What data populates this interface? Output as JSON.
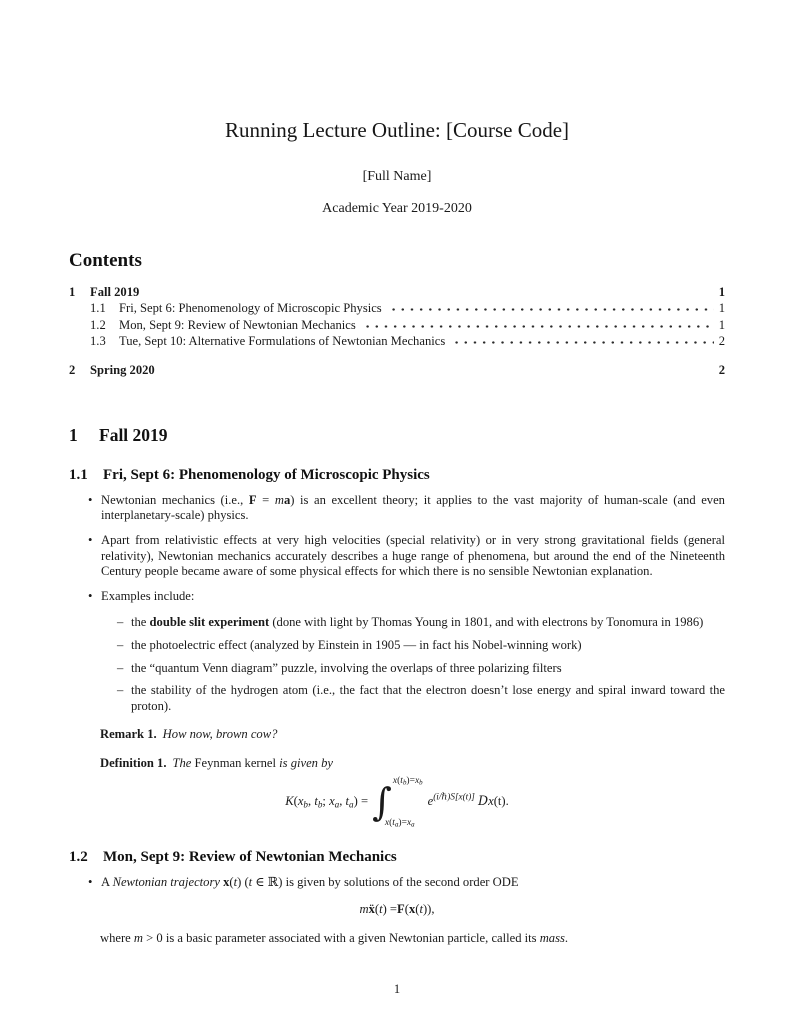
{
  "header": {
    "title": "Running Lecture Outline: [Course Code]",
    "author": "[Full Name]",
    "date": "Academic Year 2019-2020"
  },
  "contents": {
    "heading": "Contents",
    "entries": [
      {
        "num": "1",
        "label": "Fall 2019",
        "page": "1",
        "level": 1
      },
      {
        "num": "1.1",
        "label": "Fri, Sept 6: Phenomenology of Microscopic Physics",
        "page": "1",
        "level": 2
      },
      {
        "num": "1.2",
        "label": "Mon, Sept 9: Review of Newtonian Mechanics",
        "page": "1",
        "level": 2
      },
      {
        "num": "1.3",
        "label": "Tue, Sept 10: Alternative Formulations of Newtonian Mechanics",
        "page": "2",
        "level": 2
      },
      {
        "num": "2",
        "label": "Spring 2020",
        "page": "2",
        "level": 1
      }
    ]
  },
  "markers": {
    "bullet": "•",
    "dash": "–"
  },
  "section1": {
    "num": "1",
    "title": "Fall 2019"
  },
  "sub11": {
    "num": "1.1",
    "title": "Fri, Sept 6: Phenomenology of Microscopic Physics",
    "bullets": [
      [
        {
          "t": "Newtonian mechanics (i.e., "
        },
        {
          "t": "F",
          "c": "b"
        },
        {
          "t": " = "
        },
        {
          "t": "m",
          "c": "i"
        },
        {
          "t": "a",
          "c": "b"
        },
        {
          "t": ") is an excellent theory; it applies to the vast majority of human-scale (and even interplanetary-scale) physics."
        }
      ],
      [
        {
          "t": "Apart from relativistic effects at very high velocities (special relativity) or in very strong gravitational fields (general relativity), Newtonian mechanics accurately describes a huge range of phenomena, but around the end of the Nineteenth Century people became aware of some physical effects for which there is no sensible Newtonian explanation."
        }
      ],
      [
        {
          "t": "Examples include:"
        }
      ]
    ],
    "subbullets": [
      [
        {
          "t": "the "
        },
        {
          "t": "double slit experiment",
          "c": "b"
        },
        {
          "t": " (done with light by Thomas Young in 1801, and with electrons by Tonomura in 1986)"
        }
      ],
      [
        {
          "t": "the photoelectric effect (analyzed by Einstein in 1905 — in fact his Nobel-winning work)"
        }
      ],
      [
        {
          "t": "the “quantum Venn diagram” puzzle, involving the overlaps of three polarizing filters"
        }
      ],
      [
        {
          "t": "the stability of the hydrogen atom (i.e., the fact that the electron doesn’t lose energy and spiral inward toward the proton)."
        }
      ]
    ],
    "remark_label": "Remark 1.",
    "remark_body": [
      {
        "t": "How now, brown cow?",
        "c": "i"
      }
    ],
    "definition_label": "Definition 1.",
    "definition_body": [
      {
        "t": "The ",
        "c": "i"
      },
      {
        "t": "Feynman kernel"
      },
      {
        "t": " is given by",
        "c": "i"
      }
    ],
    "kernel": {
      "lhs": [
        {
          "t": "K",
          "c": "i"
        },
        {
          "t": "("
        },
        {
          "t": "x",
          "c": "i"
        },
        {
          "t": "b",
          "c": "i sub"
        },
        {
          "t": ", "
        },
        {
          "t": "t",
          "c": "i"
        },
        {
          "t": "b",
          "c": "i sub"
        },
        {
          "t": "; "
        },
        {
          "t": "x",
          "c": "i"
        },
        {
          "t": "a",
          "c": "i sub"
        },
        {
          "t": ", "
        },
        {
          "t": "t",
          "c": "i"
        },
        {
          "t": "a",
          "c": "i sub"
        },
        {
          "t": ") = "
        }
      ],
      "integral_sign": "∫",
      "upper": [
        {
          "t": "x",
          "c": "i"
        },
        {
          "t": "("
        },
        {
          "t": "t",
          "c": "i"
        },
        {
          "t": "b",
          "c": "i sub"
        },
        {
          "t": ")="
        },
        {
          "t": "x",
          "c": "i"
        },
        {
          "t": "b",
          "c": "i sub"
        }
      ],
      "lower": [
        {
          "t": "x",
          "c": "i"
        },
        {
          "t": "("
        },
        {
          "t": "t",
          "c": "i"
        },
        {
          "t": "a",
          "c": "i sub"
        },
        {
          "t": ")="
        },
        {
          "t": "x",
          "c": "i"
        },
        {
          "t": "a",
          "c": "i sub"
        }
      ],
      "integrand": [
        {
          "t": "e",
          "c": "i"
        },
        {
          "t": "(i/ℏ)S[x(t)]",
          "c": "i sup"
        },
        {
          "t": " "
        },
        {
          "t": "D",
          "c": "i scr"
        },
        {
          "t": "x",
          "c": "i"
        },
        {
          "t": "(t)."
        }
      ]
    }
  },
  "sub12": {
    "num": "1.2",
    "title": "Mon, Sept 9: Review of Newtonian Mechanics",
    "bullet": [
      {
        "t": "A "
      },
      {
        "t": "Newtonian trajectory",
        "c": "i"
      },
      {
        "t": " "
      },
      {
        "t": "x",
        "c": "b"
      },
      {
        "t": "("
      },
      {
        "t": "t",
        "c": "i"
      },
      {
        "t": ") ("
      },
      {
        "t": "t",
        "c": "i"
      },
      {
        "t": " ∈ ℝ) is given by solutions of the second order ODE"
      }
    ],
    "ode": [
      {
        "t": "m",
        "c": "i"
      },
      {
        "t": " "
      },
      {
        "t": "ẍ",
        "c": "b"
      },
      {
        "t": "("
      },
      {
        "t": "t",
        "c": "i"
      },
      {
        "t": ") = "
      },
      {
        "t": "F",
        "c": "b"
      },
      {
        "t": "("
      },
      {
        "t": "x",
        "c": "b"
      },
      {
        "t": "("
      },
      {
        "t": "t",
        "c": "i"
      },
      {
        "t": ")),"
      }
    ],
    "after": [
      {
        "t": "where "
      },
      {
        "t": "m",
        "c": "i"
      },
      {
        "t": " > 0 is a basic parameter associated with a given Newtonian particle, called its "
      },
      {
        "t": "mass",
        "c": "i"
      },
      {
        "t": "."
      }
    ]
  },
  "footer": {
    "page_number": "1"
  }
}
